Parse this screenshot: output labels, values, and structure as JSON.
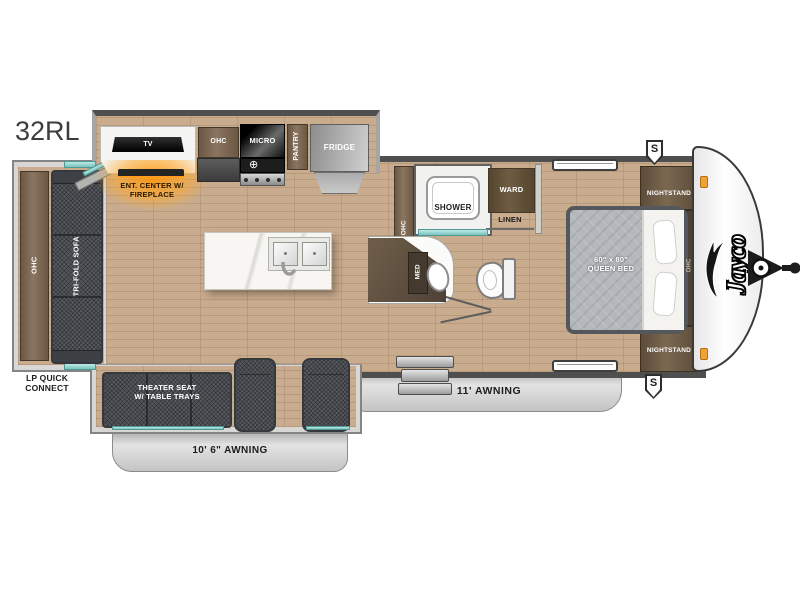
{
  "model": "32RL",
  "brand": "Jayco",
  "marker_top": "S",
  "marker_bottom": "S",
  "rear": {
    "ohc": "OHC",
    "sofa": "TRI-FOLD SOFA",
    "lp1": "LP QUICK",
    "lp2": "CONNECT"
  },
  "ent": {
    "tv": "TV",
    "line1": "ENT. CENTER W/",
    "line2": "FIREPLACE"
  },
  "kitchen": {
    "ohc": "OHC",
    "micro": "MICRO",
    "pantry": "PANTRY",
    "fridge": "FRIDGE"
  },
  "bath": {
    "ohc": "OHC",
    "shower": "SHOWER",
    "ward": "WARD",
    "linen": "LINEN",
    "med": "MED"
  },
  "bedroom": {
    "ns_top": "NIGHTSTAND",
    "ns_bottom": "NIGHTSTAND",
    "bed1": "60\" x 80\"",
    "bed2": "QUEEN BED",
    "ohc": "OHC"
  },
  "living": {
    "th1": "THEATER SEAT",
    "th2": "W/ TABLE TRAYS"
  },
  "awnings": {
    "door": "11' AWNING",
    "rear": "10' 6\" AWNING"
  },
  "icons": {
    "burner": "⊕"
  },
  "colors": {
    "wall": "#4f4f4f",
    "wood": "#c9ac8e",
    "cabinet": "#6b5742",
    "seat": "#56595e",
    "awning": "#c9c9c9",
    "glow": "#ffa72e",
    "glass": "#79c3be",
    "accent_light": "#f2a233"
  }
}
